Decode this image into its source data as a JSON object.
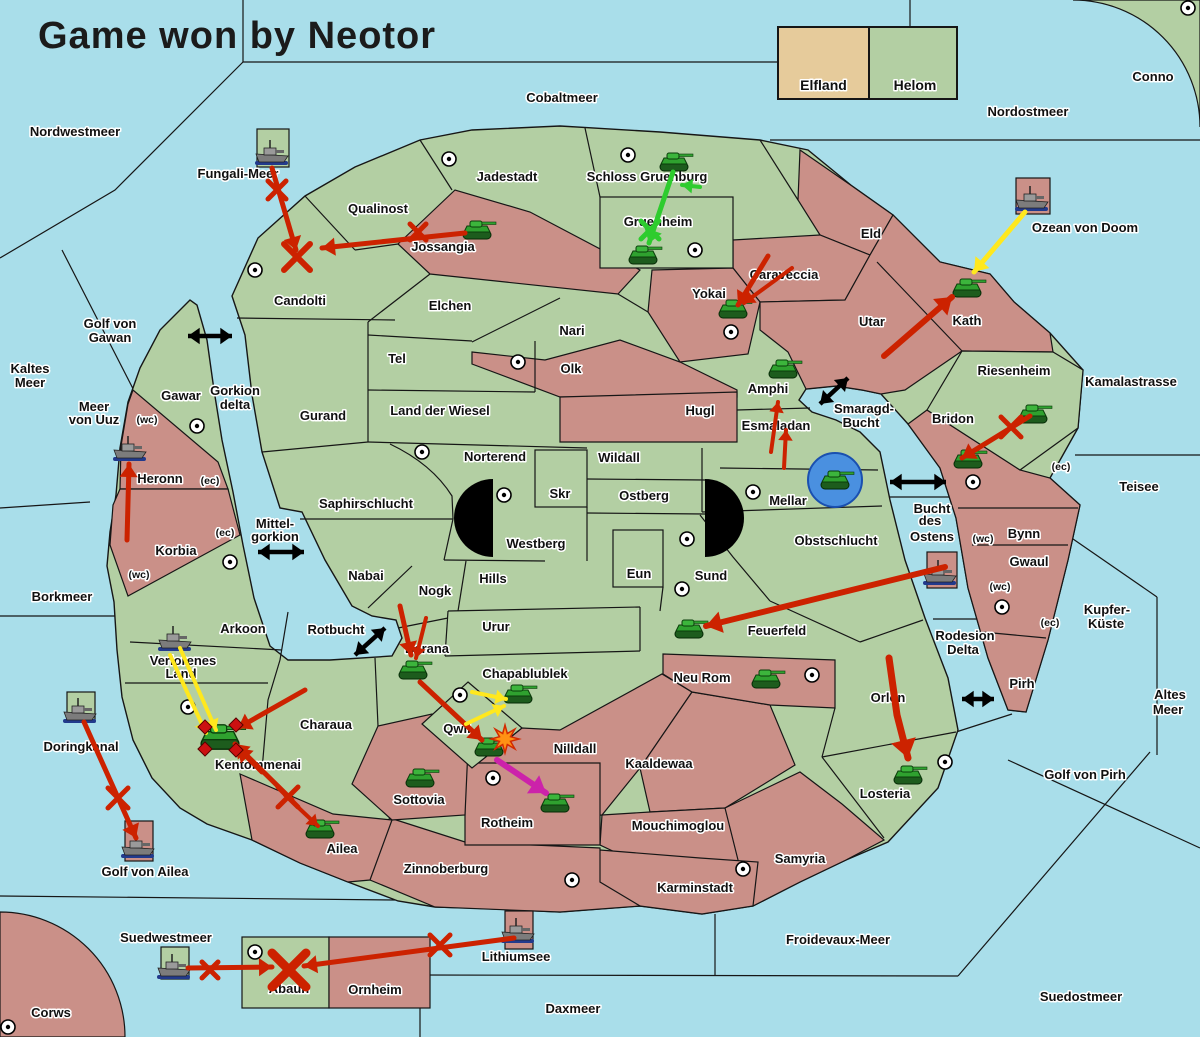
{
  "title": "Game won by Neotor",
  "legend": {
    "factions": [
      {
        "name": "Elfland",
        "color": "#e6cb9b"
      },
      {
        "name": "Helom",
        "color": "#b3cfa3"
      }
    ]
  },
  "colors": {
    "sea": "#a9deea",
    "green_land": "#b3cfa3",
    "red_land": "#ca9088",
    "tan_land": "#e6cb9b",
    "border": "#161616",
    "arrow_red": "#cc2200",
    "arrow_yellow": "#ffe81e",
    "arrow_green": "#2ecc2e",
    "arrow_magenta": "#cc22aa",
    "arrow_black": "#000000"
  },
  "sea_labels": [
    {
      "text": "Nordwestmeer",
      "x": 75,
      "y": 136
    },
    {
      "text": "Cobaltmeer",
      "x": 562,
      "y": 102
    },
    {
      "text": "Nordostmeer",
      "x": 1028,
      "y": 116
    },
    {
      "text": "Fungali-Meer",
      "x": 238,
      "y": 178
    },
    {
      "text": "Ozean von Doom",
      "x": 1085,
      "y": 232
    },
    {
      "text": "Kaltes",
      "x": 30,
      "y": 373
    },
    {
      "text": "Meer",
      "x": 30,
      "y": 387
    },
    {
      "text": "Golf von",
      "x": 110,
      "y": 328
    },
    {
      "text": "Gawan",
      "x": 110,
      "y": 342
    },
    {
      "text": "Meer",
      "x": 94,
      "y": 411
    },
    {
      "text": "von Uuz",
      "x": 94,
      "y": 424
    },
    {
      "text": "Gorkion",
      "x": 235,
      "y": 395
    },
    {
      "text": "delta",
      "x": 235,
      "y": 409
    },
    {
      "text": "Borkmeer",
      "x": 62,
      "y": 601
    },
    {
      "text": "Mittel-",
      "x": 275,
      "y": 528
    },
    {
      "text": "gorkion",
      "x": 275,
      "y": 541
    },
    {
      "text": "Rotbucht",
      "x": 336,
      "y": 634
    },
    {
      "text": "Smaragd-",
      "x": 864,
      "y": 413
    },
    {
      "text": "Bucht",
      "x": 861,
      "y": 427
    },
    {
      "text": "Bucht",
      "x": 932,
      "y": 513
    },
    {
      "text": "des",
      "x": 930,
      "y": 525
    },
    {
      "text": "Ostens",
      "x": 932,
      "y": 541
    },
    {
      "text": "Kamalastrasse",
      "x": 1131,
      "y": 386
    },
    {
      "text": "Teisee",
      "x": 1139,
      "y": 491
    },
    {
      "text": "Kupfer-",
      "x": 1107,
      "y": 614
    },
    {
      "text": "Küste",
      "x": 1106,
      "y": 628
    },
    {
      "text": "Rodesion",
      "x": 965,
      "y": 640
    },
    {
      "text": "Delta",
      "x": 963,
      "y": 654
    },
    {
      "text": "Altes",
      "x": 1170,
      "y": 699
    },
    {
      "text": "Meer",
      "x": 1168,
      "y": 714
    },
    {
      "text": "Golf von Pirh",
      "x": 1085,
      "y": 779
    },
    {
      "text": "Doringkanal",
      "x": 81,
      "y": 751
    },
    {
      "text": "Golf von Ailea",
      "x": 145,
      "y": 876
    },
    {
      "text": "Suedwestmeer",
      "x": 166,
      "y": 942
    },
    {
      "text": "Lithiumsee",
      "x": 516,
      "y": 961
    },
    {
      "text": "Daxmeer",
      "x": 573,
      "y": 1013
    },
    {
      "text": "Froidevaux-Meer",
      "x": 838,
      "y": 944
    },
    {
      "text": "Suedostmeer",
      "x": 1081,
      "y": 1001
    }
  ],
  "territories": [
    {
      "name": "Candolti",
      "x": 300,
      "y": 305,
      "owner": "green"
    },
    {
      "name": "Qualinost",
      "x": 378,
      "y": 213,
      "owner": "green"
    },
    {
      "name": "Jossangia",
      "x": 443,
      "y": 251,
      "owner": "red"
    },
    {
      "name": "Jadestadt",
      "x": 507,
      "y": 181,
      "owner": "green"
    },
    {
      "name": "Schloss Gruenburg",
      "x": 647,
      "y": 181,
      "owner": "green"
    },
    {
      "name": "Gruenheim",
      "x": 658,
      "y": 226,
      "owner": "green"
    },
    {
      "name": "Caraveccia",
      "x": 784,
      "y": 279,
      "owner": "red"
    },
    {
      "name": "Yokai",
      "x": 709,
      "y": 298,
      "owner": "red"
    },
    {
      "name": "Eld",
      "x": 871,
      "y": 238,
      "owner": "red"
    },
    {
      "name": "Utar",
      "x": 872,
      "y": 326,
      "owner": "red"
    },
    {
      "name": "Kath",
      "x": 967,
      "y": 325,
      "owner": "red"
    },
    {
      "name": "Riesenheim",
      "x": 1014,
      "y": 375,
      "owner": "green"
    },
    {
      "name": "Bridon",
      "x": 953,
      "y": 423,
      "owner": "red"
    },
    {
      "name": "Bynn",
      "x": 1024,
      "y": 538,
      "owner": "red"
    },
    {
      "name": "Gwaul",
      "x": 1029,
      "y": 566,
      "owner": "red"
    },
    {
      "name": "Pirh",
      "x": 1022,
      "y": 688,
      "owner": "red"
    },
    {
      "name": "Elchen",
      "x": 450,
      "y": 310,
      "owner": "green"
    },
    {
      "name": "Nari",
      "x": 572,
      "y": 335,
      "owner": "green"
    },
    {
      "name": "Olk",
      "x": 571,
      "y": 373,
      "owner": "red"
    },
    {
      "name": "Tel",
      "x": 397,
      "y": 363,
      "owner": "green"
    },
    {
      "name": "Gurand",
      "x": 323,
      "y": 420,
      "owner": "green"
    },
    {
      "name": "Land der Wiesel",
      "x": 440,
      "y": 415,
      "owner": "green"
    },
    {
      "name": "Hugl",
      "x": 700,
      "y": 415,
      "owner": "red"
    },
    {
      "name": "Amphi",
      "x": 768,
      "y": 393,
      "owner": "green"
    },
    {
      "name": "Esmaladan",
      "x": 776,
      "y": 430,
      "owner": "green"
    },
    {
      "name": "Norterend",
      "x": 495,
      "y": 461,
      "owner": "green"
    },
    {
      "name": "Wildall",
      "x": 619,
      "y": 462,
      "owner": "green"
    },
    {
      "name": "Skr",
      "x": 560,
      "y": 498,
      "owner": "green"
    },
    {
      "name": "Ostberg",
      "x": 644,
      "y": 500,
      "owner": "green"
    },
    {
      "name": "Mellar",
      "x": 788,
      "y": 505,
      "owner": "green"
    },
    {
      "name": "Westberg",
      "x": 536,
      "y": 548,
      "owner": "green"
    },
    {
      "name": "Hills",
      "x": 493,
      "y": 583,
      "owner": "green"
    },
    {
      "name": "Eun",
      "x": 639,
      "y": 578,
      "owner": "green"
    },
    {
      "name": "Sund",
      "x": 711,
      "y": 580,
      "owner": "green"
    },
    {
      "name": "Obstschlucht",
      "x": 836,
      "y": 545,
      "owner": "green"
    },
    {
      "name": "Saphirschlucht",
      "x": 366,
      "y": 508,
      "owner": "green"
    },
    {
      "name": "Nabai",
      "x": 366,
      "y": 580,
      "owner": "green"
    },
    {
      "name": "Nogk",
      "x": 435,
      "y": 595,
      "owner": "green"
    },
    {
      "name": "Urur",
      "x": 496,
      "y": 631,
      "owner": "green"
    },
    {
      "name": "Feuerfeld",
      "x": 777,
      "y": 635,
      "owner": "green"
    },
    {
      "name": "Neu Rom",
      "x": 702,
      "y": 682,
      "owner": "red"
    },
    {
      "name": "Chapablublek",
      "x": 525,
      "y": 678,
      "owner": "green"
    },
    {
      "name": "Barana",
      "x": 427,
      "y": 653,
      "owner": "green"
    },
    {
      "name": "Qwil",
      "x": 457,
      "y": 733,
      "owner": "green"
    },
    {
      "name": "Nilldall",
      "x": 575,
      "y": 753,
      "owner": "red"
    },
    {
      "name": "Kaaldewaa",
      "x": 659,
      "y": 768,
      "owner": "red"
    },
    {
      "name": "Mouchimoglou",
      "x": 678,
      "y": 830,
      "owner": "red"
    },
    {
      "name": "Gawar",
      "x": 181,
      "y": 400,
      "owner": "green"
    },
    {
      "name": "Heronn",
      "x": 160,
      "y": 483,
      "owner": "red"
    },
    {
      "name": "Korbia",
      "x": 176,
      "y": 555,
      "owner": "red"
    },
    {
      "name": "Arkoon",
      "x": 243,
      "y": 633,
      "owner": "green"
    },
    {
      "name": "Verlorenes",
      "x": 183,
      "y": 665,
      "owner": "green"
    },
    {
      "name": "Land",
      "x": 181,
      "y": 678,
      "owner": "green"
    },
    {
      "name": "Charaua",
      "x": 326,
      "y": 729,
      "owner": "green"
    },
    {
      "name": "Kentommenai",
      "x": 258,
      "y": 769,
      "owner": "green"
    },
    {
      "name": "Sottovia",
      "x": 419,
      "y": 804,
      "owner": "red"
    },
    {
      "name": "Rotheim",
      "x": 507,
      "y": 827,
      "owner": "red"
    },
    {
      "name": "Ailea",
      "x": 342,
      "y": 853,
      "owner": "red"
    },
    {
      "name": "Zinnoberburg",
      "x": 446,
      "y": 873,
      "owner": "red"
    },
    {
      "name": "Samyria",
      "x": 800,
      "y": 863,
      "owner": "red"
    },
    {
      "name": "Karminstadt",
      "x": 695,
      "y": 892,
      "owner": "red"
    },
    {
      "name": "Orlon",
      "x": 888,
      "y": 702,
      "owner": "green"
    },
    {
      "name": "Losteria",
      "x": 885,
      "y": 798,
      "owner": "green"
    },
    {
      "name": "Abaun",
      "x": 289,
      "y": 993,
      "owner": "green"
    },
    {
      "name": "Ornheim",
      "x": 375,
      "y": 994,
      "owner": "red"
    },
    {
      "name": "Conno",
      "x": 1153,
      "y": 81,
      "owner": "green"
    },
    {
      "name": "Corws",
      "x": 51,
      "y": 1017,
      "owner": "red"
    }
  ],
  "small_markers": [
    {
      "text": "(wc)",
      "x": 147,
      "y": 423
    },
    {
      "text": "(ec)",
      "x": 210,
      "y": 484
    },
    {
      "text": "(ec)",
      "x": 225,
      "y": 536
    },
    {
      "text": "(wc)",
      "x": 139,
      "y": 578
    },
    {
      "text": "(wc)",
      "x": 983,
      "y": 542
    },
    {
      "text": "(wc)",
      "x": 1000,
      "y": 590
    },
    {
      "text": "(ec)",
      "x": 1050,
      "y": 626
    },
    {
      "text": "(ec)",
      "x": 1061,
      "y": 470
    }
  ],
  "town_dots": [
    [
      449,
      159
    ],
    [
      628,
      155
    ],
    [
      695,
      250
    ],
    [
      255,
      270
    ],
    [
      197,
      426
    ],
    [
      518,
      362
    ],
    [
      422,
      452
    ],
    [
      504,
      495
    ],
    [
      753,
      492
    ],
    [
      687,
      539
    ],
    [
      682,
      589
    ],
    [
      731,
      332
    ],
    [
      973,
      482
    ],
    [
      1002,
      607
    ],
    [
      812,
      675
    ],
    [
      945,
      762
    ],
    [
      188,
      707
    ],
    [
      230,
      562
    ],
    [
      460,
      695
    ],
    [
      493,
      778
    ],
    [
      572,
      880
    ],
    [
      743,
      869
    ],
    [
      255,
      952
    ],
    [
      8,
      1027
    ],
    [
      1188,
      8
    ],
    [
      942,
      40
    ]
  ],
  "units": {
    "ships": [
      [
        272,
        152
      ],
      [
        1032,
        198
      ],
      [
        130,
        448
      ],
      [
        940,
        572
      ],
      [
        175,
        638
      ],
      [
        80,
        710
      ],
      [
        138,
        845
      ],
      [
        174,
        966
      ],
      [
        518,
        930
      ]
    ],
    "tanks": [
      [
        674,
        162
      ],
      [
        643,
        255
      ],
      [
        477,
        230
      ],
      [
        733,
        309
      ],
      [
        783,
        369
      ],
      [
        967,
        288
      ],
      [
        1033,
        414
      ],
      [
        968,
        459
      ],
      [
        689,
        629
      ],
      [
        766,
        679
      ],
      [
        518,
        694
      ],
      [
        413,
        670
      ],
      [
        489,
        747
      ],
      [
        420,
        778
      ],
      [
        555,
        803
      ],
      [
        320,
        829
      ],
      [
        908,
        775
      ]
    ],
    "big_tank": [
      220,
      737
    ],
    "amphibious": [
      [
        835,
        480
      ]
    ]
  },
  "arrows": [
    {
      "c": "red",
      "w": 5,
      "p": [
        [
          272,
          168
        ],
        [
          296,
          250
        ]
      ]
    },
    {
      "c": "red",
      "w": 5,
      "p": [
        [
          465,
          233
        ],
        [
          322,
          248
        ]
      ]
    },
    {
      "c": "red",
      "w": 5,
      "p": [
        [
          768,
          256
        ],
        [
          738,
          305
        ]
      ]
    },
    {
      "c": "red",
      "w": 4,
      "p": [
        [
          792,
          268
        ],
        [
          744,
          303
        ]
      ]
    },
    {
      "c": "red",
      "w": 6,
      "p": [
        [
          884,
          356
        ],
        [
          952,
          297
        ]
      ]
    },
    {
      "c": "red",
      "w": 5,
      "p": [
        [
          1030,
          416
        ],
        [
          962,
          458
        ]
      ]
    },
    {
      "c": "red",
      "w": 6,
      "p": [
        [
          945,
          567
        ],
        [
          706,
          626
        ]
      ]
    },
    {
      "c": "red",
      "w": 4,
      "p": [
        [
          771,
          452
        ],
        [
          778,
          402
        ]
      ]
    },
    {
      "c": "red",
      "w": 4,
      "p": [
        [
          784,
          468
        ],
        [
          786,
          430
        ]
      ]
    },
    {
      "c": "red",
      "w": 5,
      "p": [
        [
          127,
          540
        ],
        [
          129,
          464
        ]
      ]
    },
    {
      "c": "red",
      "w": 7,
      "p": [
        [
          889,
          658
        ],
        [
          897,
          715
        ],
        [
          908,
          758
        ]
      ]
    },
    {
      "c": "red",
      "w": 5,
      "p": [
        [
          400,
          606
        ],
        [
          411,
          655
        ]
      ]
    },
    {
      "c": "red",
      "w": 4,
      "p": [
        [
          426,
          618
        ],
        [
          416,
          658
        ]
      ]
    },
    {
      "c": "red",
      "w": 5,
      "p": [
        [
          420,
          682
        ],
        [
          482,
          740
        ]
      ]
    },
    {
      "c": "red",
      "w": 5,
      "p": [
        [
          305,
          690
        ],
        [
          238,
          728
        ]
      ]
    },
    {
      "c": "red",
      "w": 5,
      "p": [
        [
          262,
          772
        ],
        [
          238,
          748
        ]
      ]
    },
    {
      "c": "red",
      "w": 5,
      "p": [
        [
          292,
          800
        ],
        [
          235,
          744
        ]
      ]
    },
    {
      "c": "red",
      "w": 4,
      "p": [
        [
          285,
          795
        ],
        [
          318,
          826
        ]
      ]
    },
    {
      "c": "red",
      "w": 5,
      "p": [
        [
          84,
          722
        ],
        [
          136,
          838
        ]
      ]
    },
    {
      "c": "red",
      "w": 5,
      "p": [
        [
          188,
          968
        ],
        [
          272,
          967
        ]
      ]
    },
    {
      "c": "red",
      "w": 5,
      "p": [
        [
          514,
          938
        ],
        [
          304,
          966
        ]
      ]
    },
    {
      "c": "yellow",
      "w": 5,
      "p": [
        [
          1025,
          212
        ],
        [
          974,
          272
        ]
      ]
    },
    {
      "c": "yellow",
      "w": 4,
      "p": [
        [
          472,
          692
        ],
        [
          506,
          699
        ]
      ]
    },
    {
      "c": "yellow",
      "w": 4,
      "p": [
        [
          466,
          724
        ],
        [
          504,
          706
        ]
      ]
    },
    {
      "c": "yellow",
      "w": 4,
      "p": [
        [
          180,
          648
        ],
        [
          216,
          730
        ]
      ]
    },
    {
      "c": "yellow",
      "w": 4,
      "p": [
        [
          170,
          655
        ],
        [
          206,
          733
        ]
      ]
    },
    {
      "c": "green",
      "w": 5,
      "p": [
        [
          673,
          172
        ],
        [
          649,
          243
        ]
      ]
    },
    {
      "c": "green",
      "w": 4,
      "p": [
        [
          700,
          187
        ],
        [
          682,
          185
        ]
      ]
    },
    {
      "c": "magenta",
      "w": 6,
      "p": [
        [
          497,
          760
        ],
        [
          546,
          793
        ]
      ]
    }
  ],
  "double_arrows": [
    [
      [
        188,
        336
      ],
      [
        232,
        336
      ]
    ],
    [
      [
        258,
        552
      ],
      [
        304,
        552
      ]
    ],
    [
      [
        820,
        404
      ],
      [
        848,
        378
      ]
    ],
    [
      [
        890,
        482
      ],
      [
        946,
        482
      ]
    ],
    [
      [
        355,
        655
      ],
      [
        385,
        628
      ]
    ],
    [
      [
        962,
        699
      ],
      [
        994,
        699
      ]
    ]
  ],
  "x_marks": [
    {
      "x": 277,
      "y": 190,
      "s": 9,
      "w": 5,
      "c": "red"
    },
    {
      "x": 297,
      "y": 257,
      "s": 13,
      "w": 6,
      "c": "red"
    },
    {
      "x": 418,
      "y": 232,
      "s": 8,
      "w": 5,
      "c": "red"
    },
    {
      "x": 1011,
      "y": 427,
      "s": 10,
      "w": 5,
      "c": "red"
    },
    {
      "x": 650,
      "y": 230,
      "s": 9,
      "w": 5,
      "c": "green"
    },
    {
      "x": 288,
      "y": 797,
      "s": 10,
      "w": 5,
      "c": "red"
    },
    {
      "x": 118,
      "y": 798,
      "s": 10,
      "w": 5,
      "c": "red"
    },
    {
      "x": 210,
      "y": 970,
      "s": 8,
      "w": 5,
      "c": "red"
    },
    {
      "x": 440,
      "y": 945,
      "s": 10,
      "w": 5,
      "c": "red"
    },
    {
      "x": 289,
      "y": 970,
      "s": 17,
      "w": 9,
      "c": "red"
    }
  ],
  "explosions": [
    [
      505,
      739
    ]
  ],
  "diamonds": [
    [
      205,
      727
    ],
    [
      236,
      725
    ],
    [
      205,
      749
    ],
    [
      236,
      750
    ]
  ]
}
